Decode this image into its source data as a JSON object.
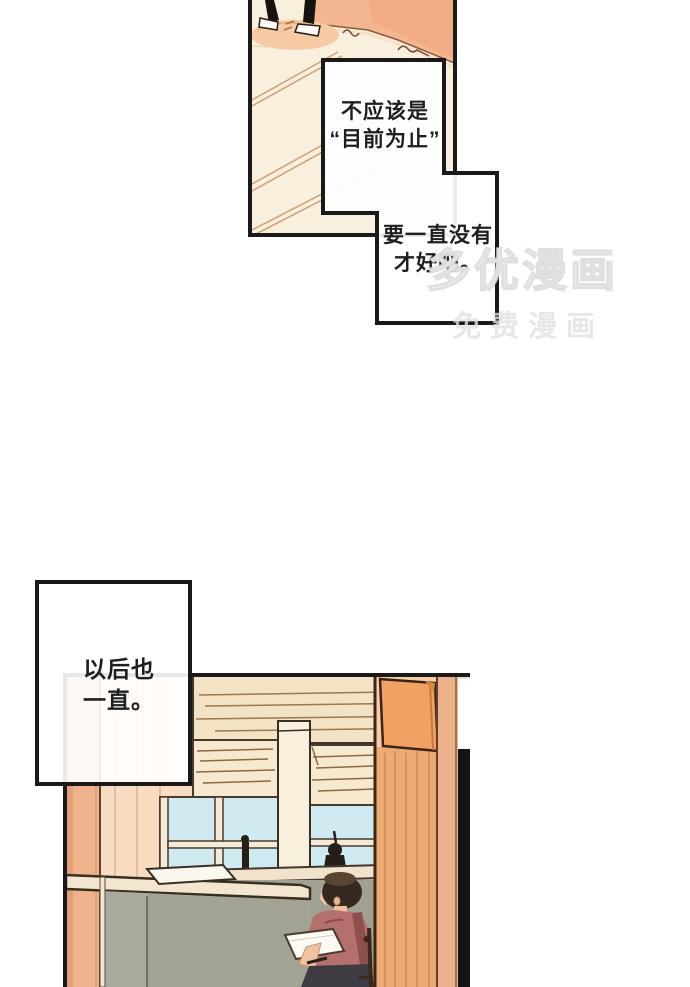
{
  "page": {
    "width": 690,
    "height": 987,
    "background": "#ffffff",
    "type": "comic-page"
  },
  "bubbles": {
    "b1": {
      "text": "不应该是\n“目前为止”"
    },
    "b2": {
      "text": "要一直没有\n才好吧。"
    },
    "b3": {
      "text": "以后也\n一直。"
    }
  },
  "watermark": {
    "line1": "多优漫画",
    "line2": "免费漫画"
  },
  "colors": {
    "panel_border": "#1a1a1a",
    "floor_cream": "#f8efdc",
    "floor_tile_line": "#d2a076",
    "wall_salmon": "#f4b690",
    "shadow_peach": "#f6caa3",
    "wall_peach": "#f8dcc2",
    "door_frame_salmon": "#eeb28c",
    "valance_cream": "#f3e2c3",
    "blind_cream": "#f6e9cf",
    "sky_blue": "#cfeaf1",
    "pillar_cream": "#f8efdd",
    "partition_gray_green": "#a9aa9c",
    "rail_cream": "#f3e6d0",
    "sign_orange": "#f1a263",
    "door_orange": "#edaa73",
    "door_gap_black": "#131313",
    "hair_dark": "#33291f",
    "skin": "#f2c29c",
    "shirt_mauve": "#b56f6d",
    "strap_red": "#8f4f4d",
    "pants_dark": "#3e3c42",
    "paper_white": "#fdfbf5",
    "silhouette": "#241f1a"
  }
}
